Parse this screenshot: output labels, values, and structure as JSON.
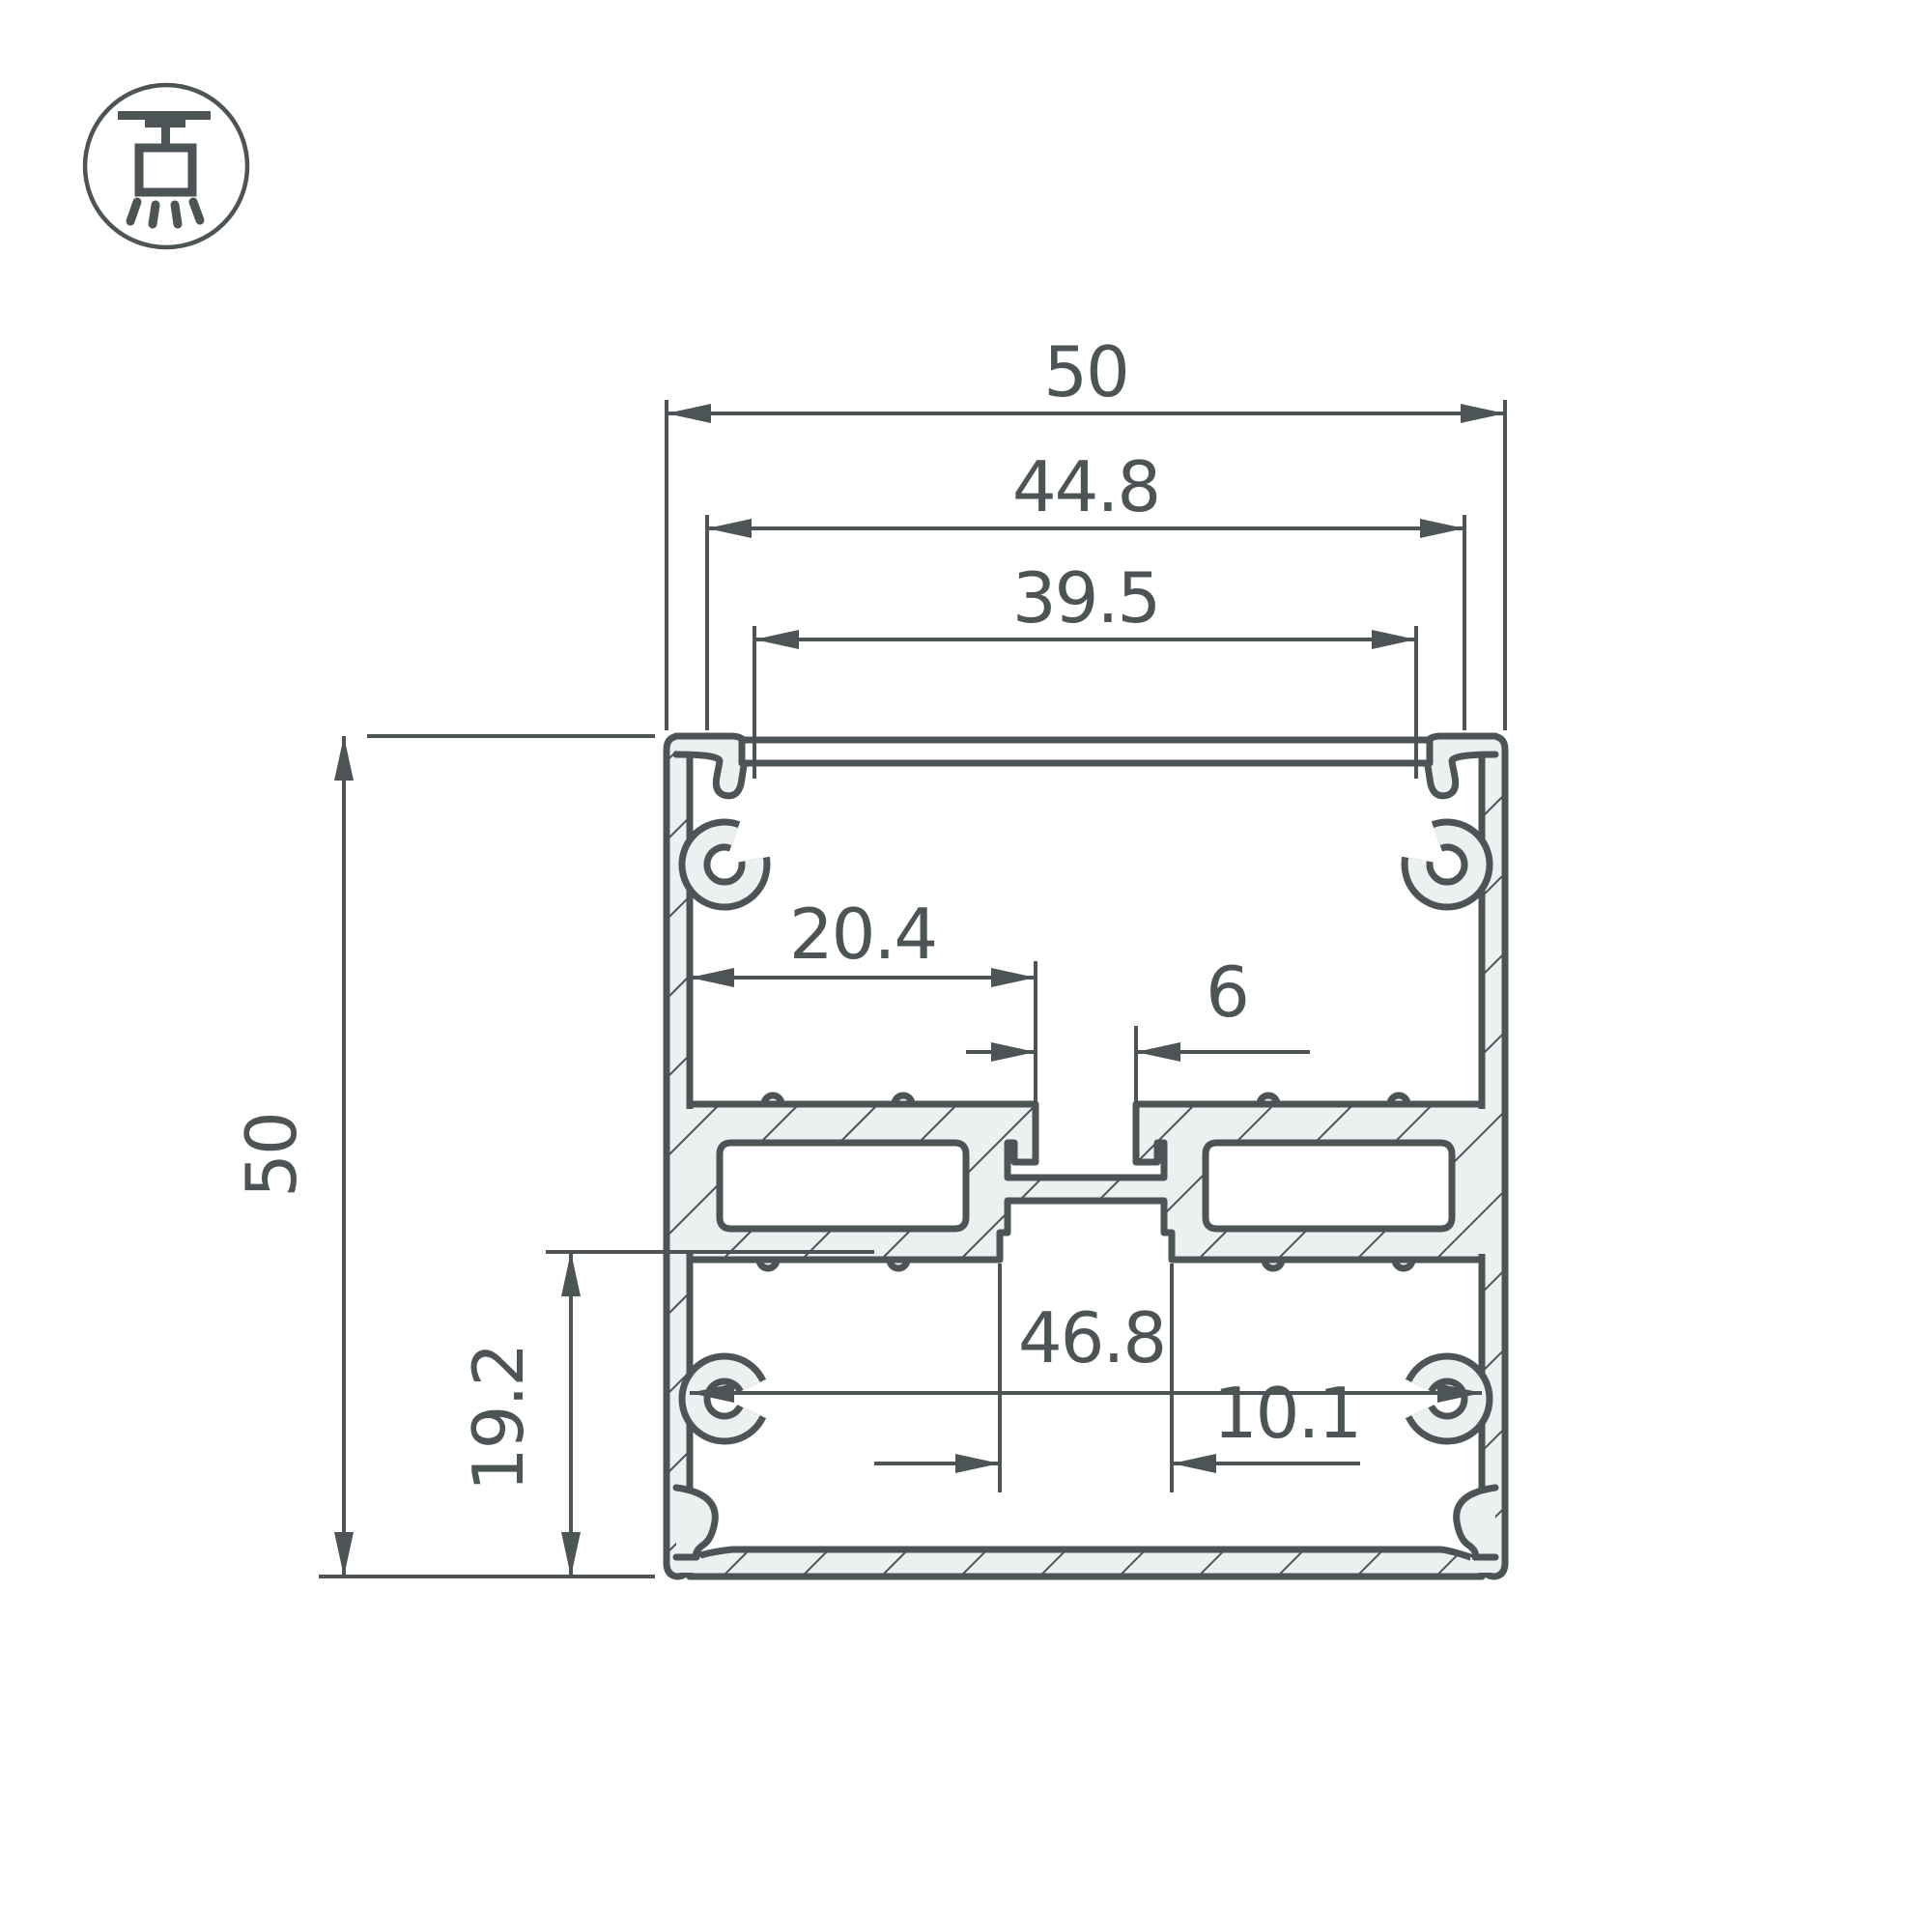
{
  "meta": {
    "background": "#ffffff",
    "line_color": "#4d5456",
    "metal_color": "#edf0f0"
  },
  "drawing": {
    "type": "aluminium-led-profile-cross-section",
    "icon": "ceiling-pendant-light-icon",
    "dimensions": {
      "outer_width": "50",
      "flange_width": "44.8",
      "groove_width": "39.5",
      "outer_height": "50",
      "bottom_section_height": "19.2",
      "shelf_width": "20.4",
      "top_slot_width": "6",
      "inner_width": "46.8",
      "bottom_slot_width": "10.1"
    }
  }
}
